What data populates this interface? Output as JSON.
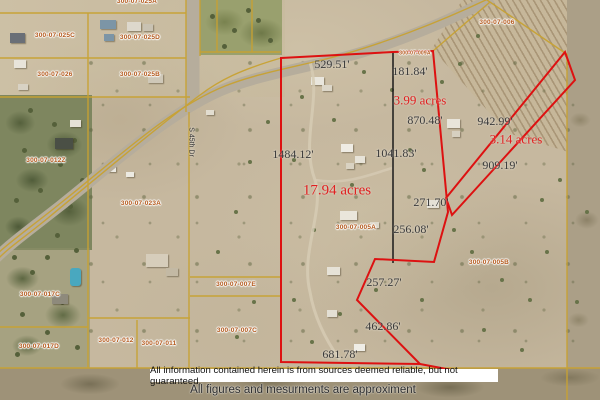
{
  "street": {
    "name": "S 45th Dr"
  },
  "parcel_ids": [
    "300-07-025A",
    "300-07-025C",
    "300-07-025D",
    "300-07-026",
    "300-07-025B",
    "300-07-012Z",
    "300-07-023A",
    "300-07-009A",
    "300-07-006",
    "300-07-005A",
    "300-07-005B",
    "300-07-007E",
    "300-07-007C",
    "300-07-017C",
    "300-07-017D",
    "300-07-012",
    "300-07-011"
  ],
  "measurements": [
    "529.51'",
    "181.84'",
    "870.48'",
    "1484.12'",
    "1041.83'",
    "942.99'",
    "909.19'",
    "271.70'",
    "256.08'",
    "257.27'",
    "462.86'",
    "681.78'"
  ],
  "acreages": [
    "3.99 acres",
    "17.94 acres",
    "3.14 acres"
  ],
  "disclaimer": {
    "line1": "All information contained herein is from sources deemed reliable, but not guaranteed.",
    "line2": "All figures and mesurments are approximent"
  },
  "colors": {
    "boundary_red": "#dd1111",
    "parcel_line_yellow": "#c8a232",
    "divider_black": "#1a1a1a",
    "parcel_id_text": "#b4591c",
    "measurement_text": "#3a3a3a",
    "acreage_text": "#e02020",
    "road_gray": "#b6ad9c"
  }
}
